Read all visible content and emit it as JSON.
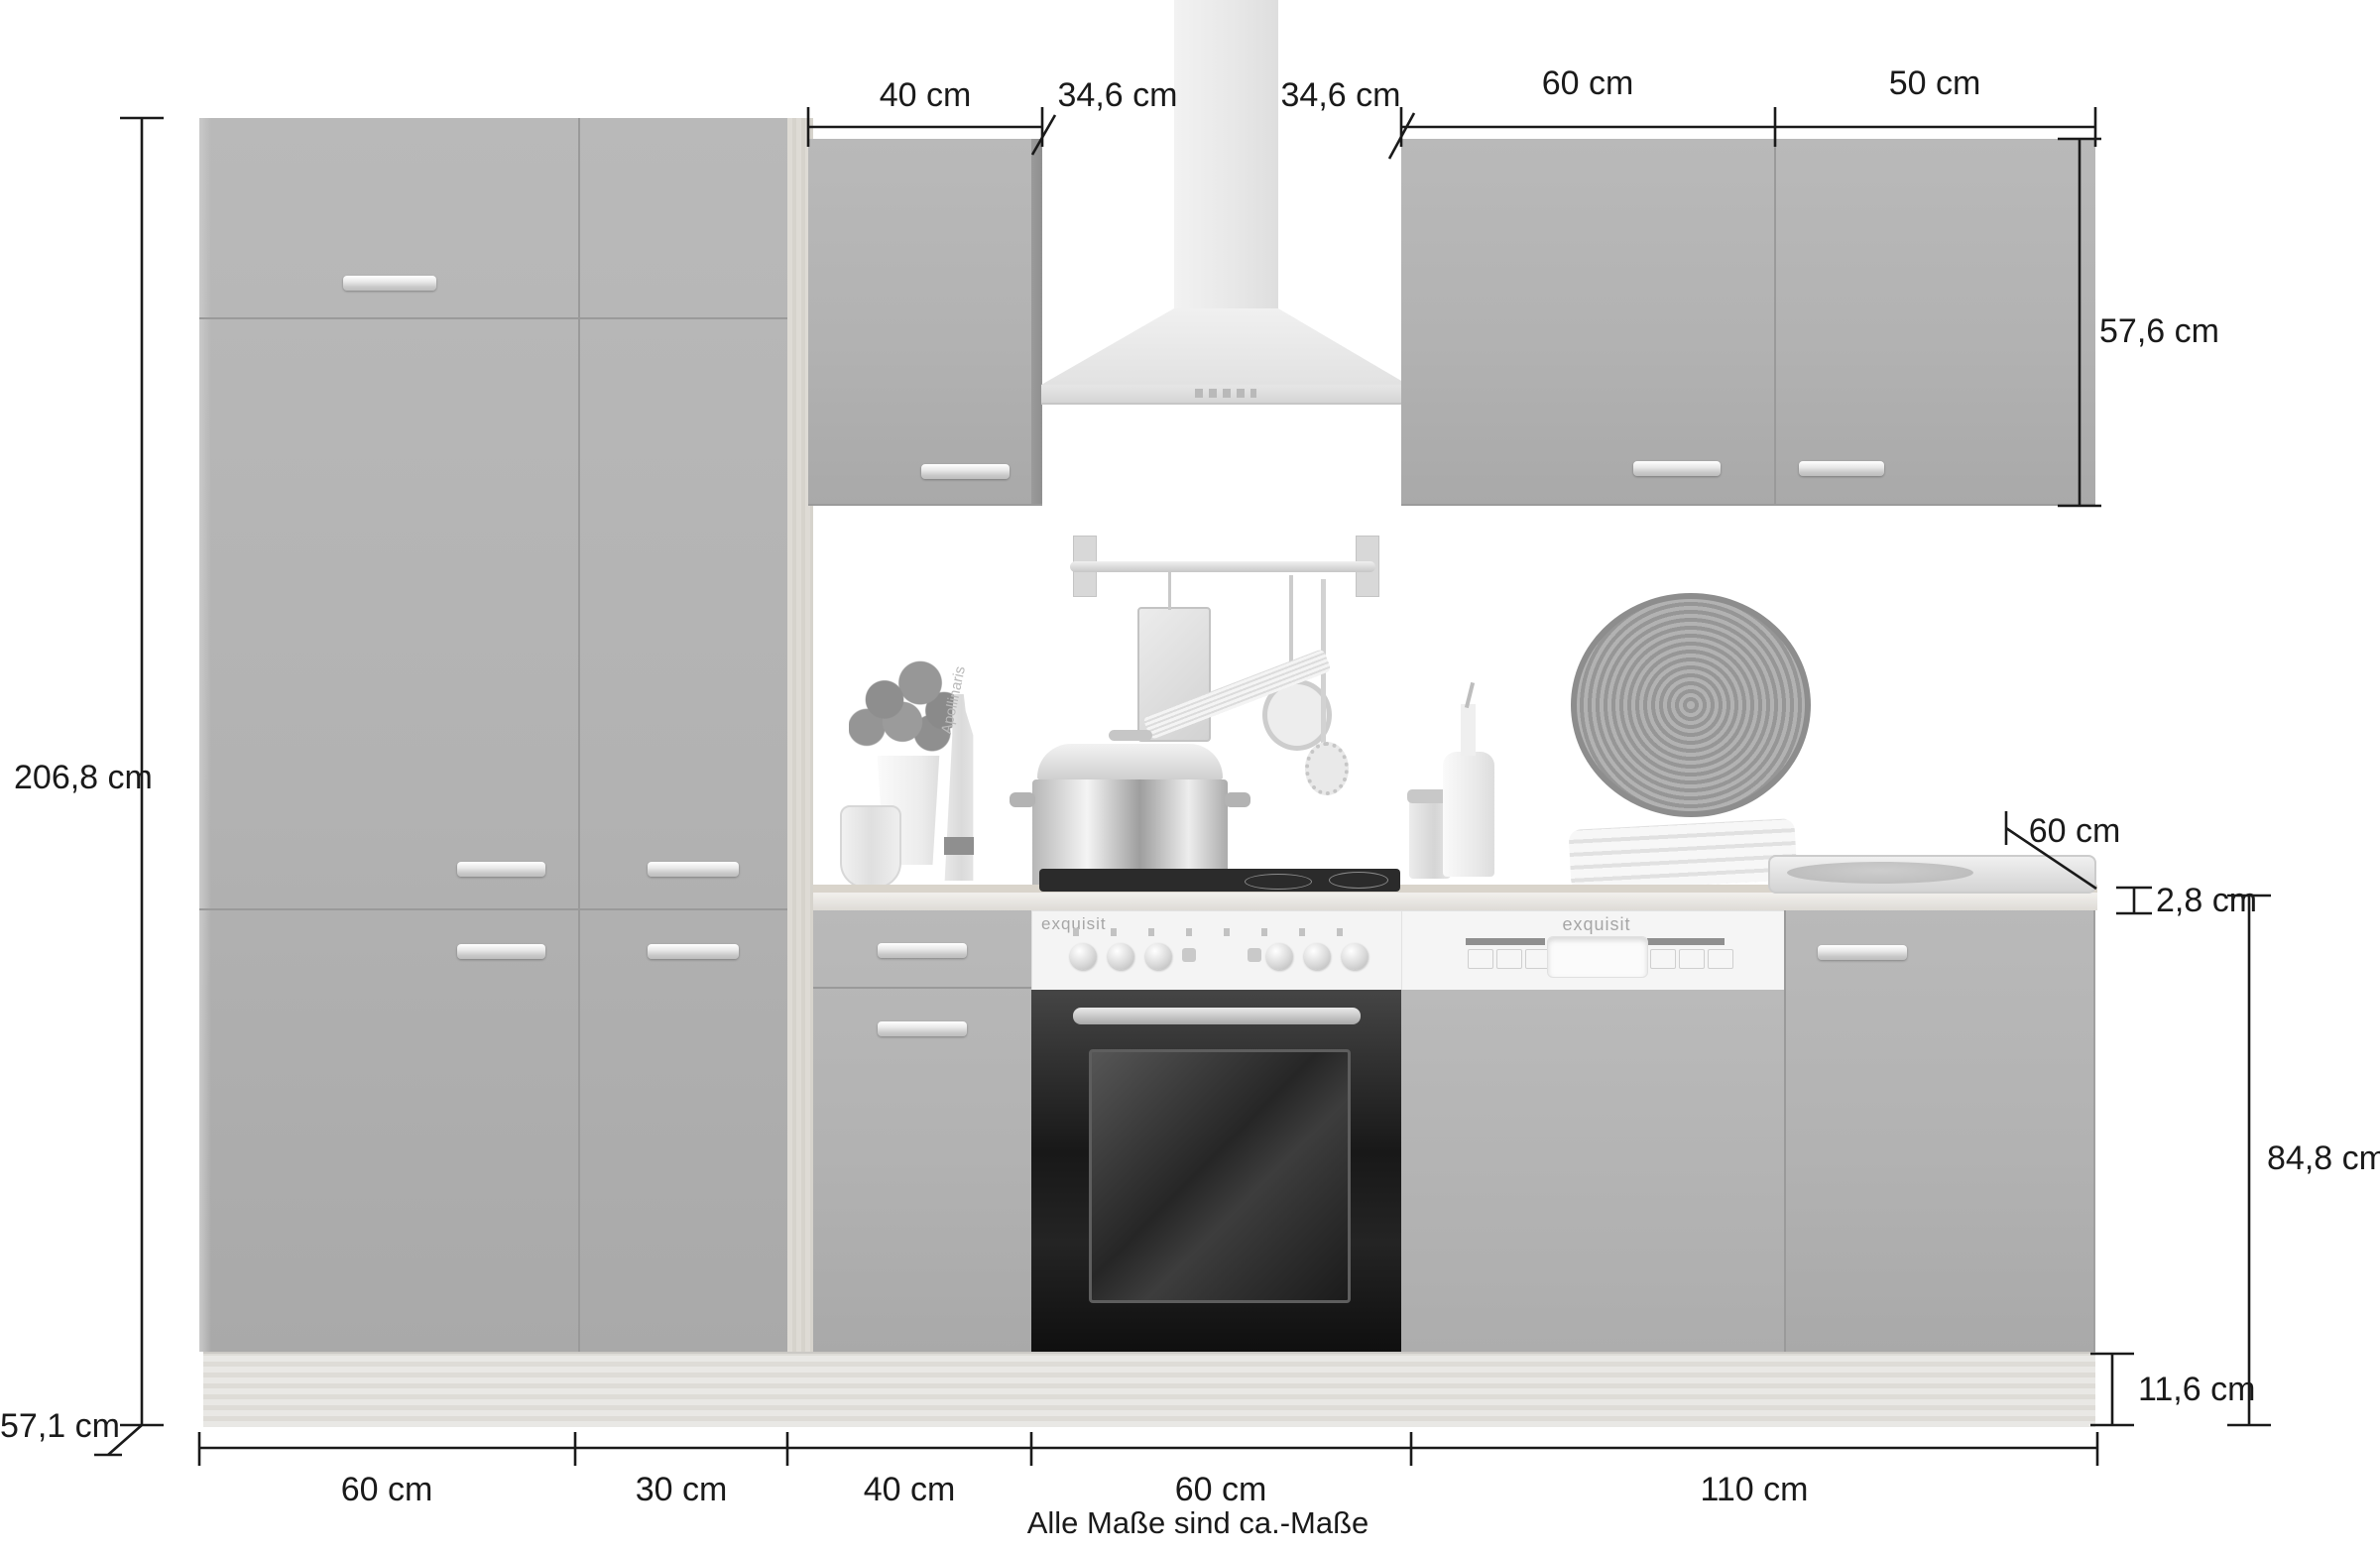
{
  "dims": {
    "top40": "40 cm",
    "gap346_left": "34,6 cm",
    "gap346_right": "34,6 cm",
    "top60": "60 cm",
    "top50": "50 cm",
    "total_height": "206,8 cm",
    "tall_depth": "57,1 cm",
    "upper_height": "57,6 cm",
    "counter_depth": "60 cm",
    "worktop_thickness": "2,8 cm",
    "base_height": "84,8 cm",
    "plinth_height": "11,6 cm",
    "bottom": [
      "60 cm",
      "30 cm",
      "40 cm",
      "60 cm",
      "110 cm"
    ]
  },
  "note": "Alle Maße sind ca.-Maße",
  "appliances": {
    "oven_brand": "exquisit",
    "dishwasher_brand": "exquisit"
  },
  "decor": {
    "bottle_label": "Apollinaris"
  },
  "colors": {
    "dimension_line": "#1a1a1a",
    "cabinet_gray": "#b2b2b2",
    "seam_gray": "#9a9a9a",
    "wood_light": "#d9d6d0",
    "worktop": "#edebe7",
    "oven_door": "#1f1f1f",
    "appliance_panel": "#f4f4f4",
    "hood_steel": "#ececec",
    "background": "#ffffff"
  }
}
